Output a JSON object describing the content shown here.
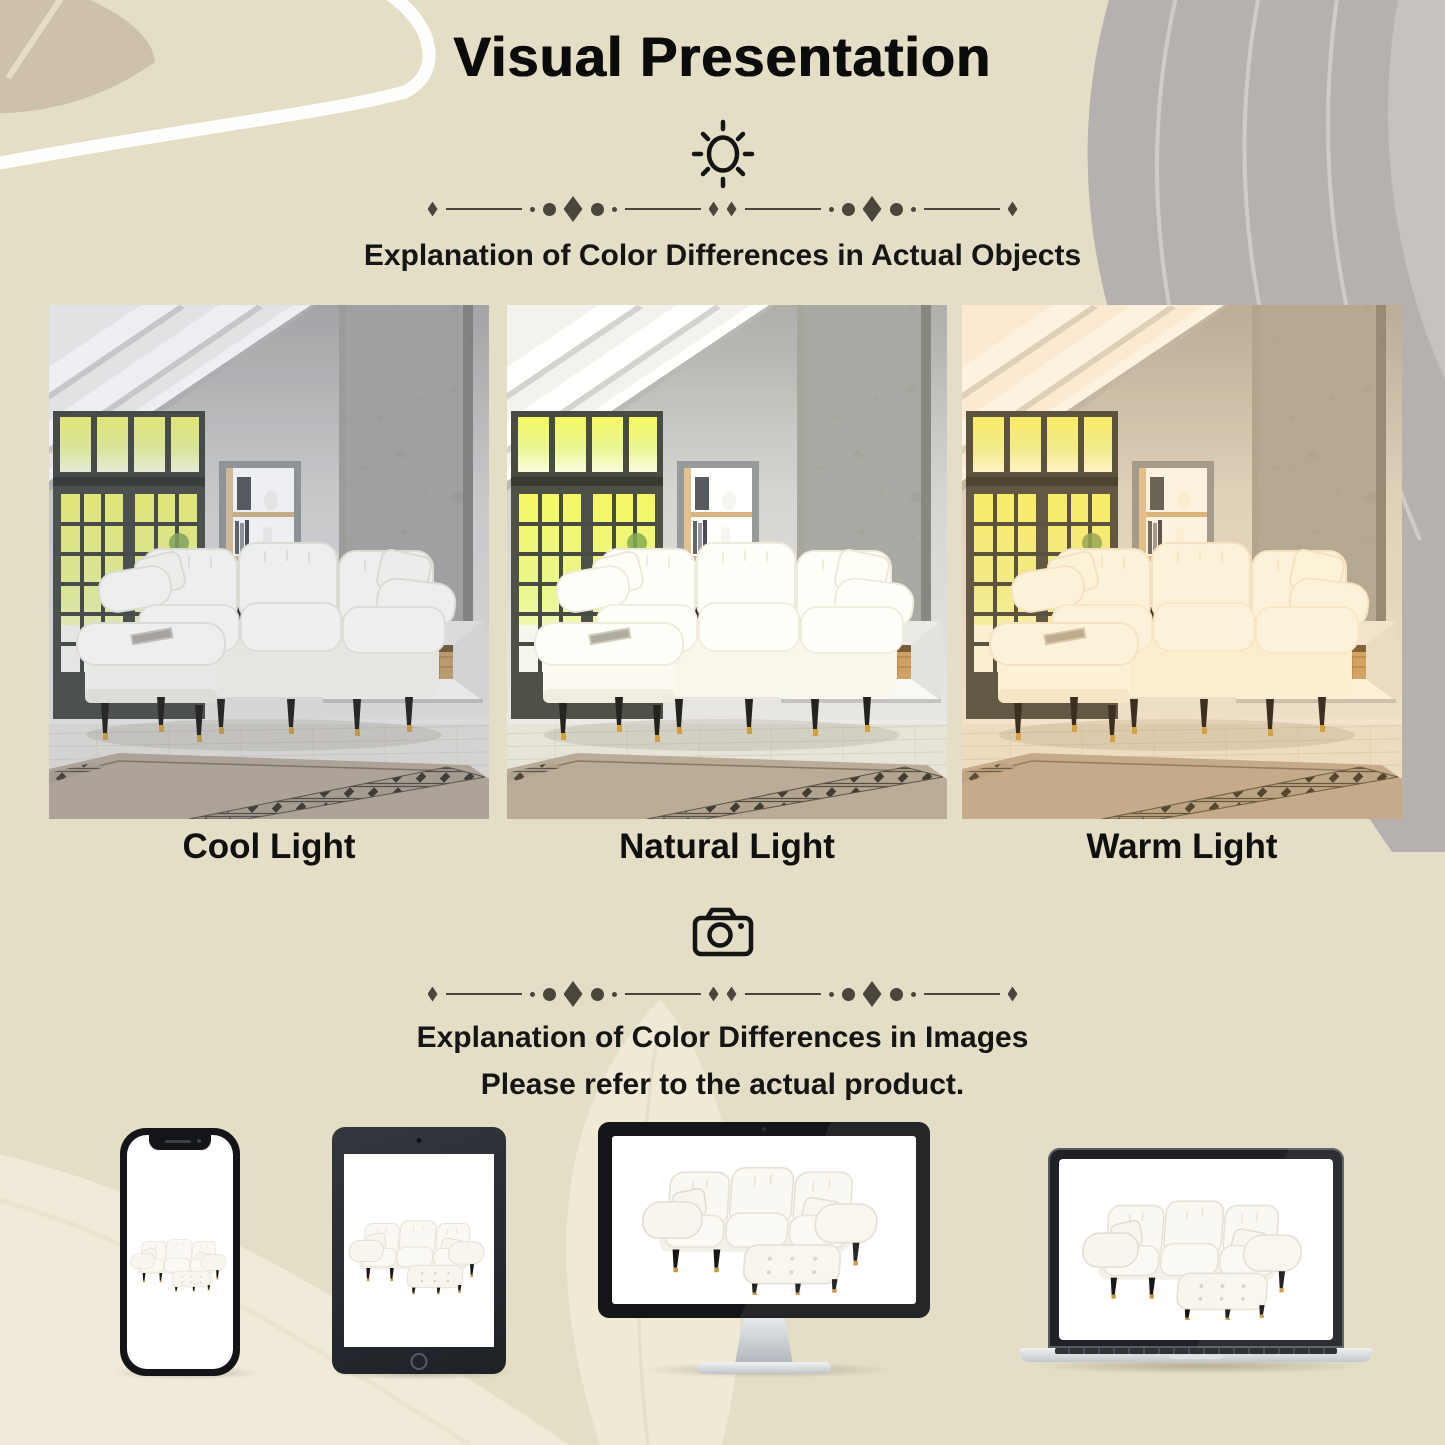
{
  "header": {
    "title": "Visual Presentation"
  },
  "sections": {
    "objects": {
      "heading": "Explanation of Color Differences in Actual Objects",
      "photos": [
        {
          "label": "Cool Light"
        },
        {
          "label": "Natural Light"
        },
        {
          "label": "Warm Light"
        }
      ]
    },
    "images": {
      "heading_line1": "Explanation of Color Differences in Images",
      "heading_line2": "Please refer to the actual product.",
      "devices": [
        "phone-mockup",
        "tablet-mockup",
        "monitor-mockup",
        "laptop-mockup"
      ]
    }
  },
  "icons": {
    "sun": "sun-icon",
    "camera": "camera-icon"
  },
  "colors": {
    "background": "#e5dec6",
    "text": "#121212",
    "ornament": "#4a463c",
    "device_frame": "#17181b",
    "leg_gold": "#c79a3d",
    "screen_white": "#ffffff"
  }
}
